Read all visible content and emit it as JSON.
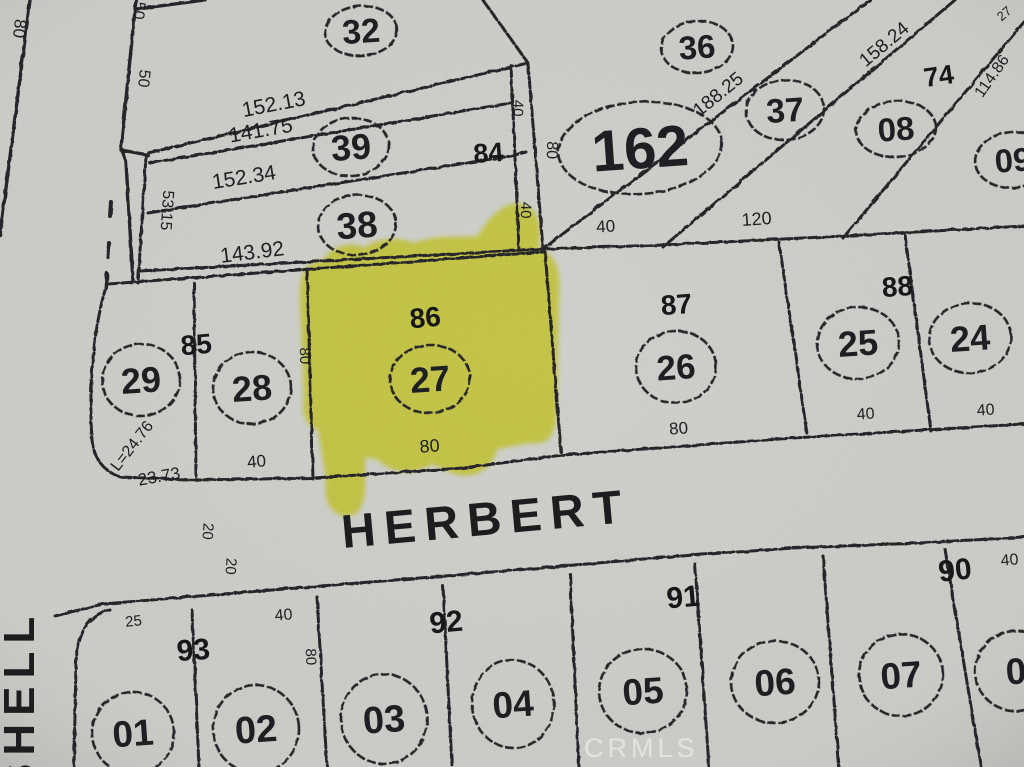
{
  "map": {
    "title": "plat-map-scan",
    "watermark": "CRMLS",
    "highlight_color": "#f0ee3c",
    "paper_color": "#d7d9d4",
    "ink_color": "#26272a",
    "street_labels": [
      {
        "text": "HERBERT",
        "x": 343,
        "y": 548,
        "s": 47,
        "r": -5.2,
        "ls": 9,
        "cls": "street",
        "name": "street-label-herbert"
      },
      {
        "text": "SHELL",
        "x": 34,
        "y": 793,
        "s": 44,
        "r": -90,
        "ls": 8,
        "cls": "street",
        "name": "street-label-shell"
      }
    ],
    "watermark_label": {
      "text": "CRMLS",
      "x": 584,
      "y": 757,
      "s": 27,
      "r": 0,
      "ls": 4,
      "cls": "watermark",
      "name": "watermark"
    },
    "lot_circles": [
      {
        "label": "32",
        "cx": 361,
        "cy": 31,
        "rx": 36,
        "ry": 25,
        "fs": 34
      },
      {
        "label": "39",
        "cx": 351,
        "cy": 147,
        "rx": 38,
        "ry": 29,
        "fs": 36
      },
      {
        "label": "38",
        "cx": 357,
        "cy": 225,
        "rx": 39,
        "ry": 30,
        "fs": 37
      },
      {
        "label": "36",
        "cx": 697,
        "cy": 47,
        "rx": 36,
        "ry": 26,
        "fs": 33
      },
      {
        "label": "37",
        "cx": 785,
        "cy": 110,
        "rx": 39,
        "ry": 30,
        "fs": 34
      },
      {
        "label": "08",
        "cx": 896,
        "cy": 129,
        "rx": 40,
        "ry": 28,
        "fs": 33
      },
      {
        "label": "09",
        "cx": 1013,
        "cy": 160,
        "rx": 38,
        "ry": 28,
        "fs": 33
      },
      {
        "label": "162",
        "cx": 640,
        "cy": 148,
        "rx": 82,
        "ry": 46,
        "fs": 58
      },
      {
        "label": "29",
        "cx": 141,
        "cy": 380,
        "rx": 39,
        "ry": 36,
        "fs": 36
      },
      {
        "label": "28",
        "cx": 252,
        "cy": 388,
        "rx": 39,
        "ry": 36,
        "fs": 36
      },
      {
        "label": "27",
        "cx": 430,
        "cy": 379,
        "rx": 40,
        "ry": 34,
        "fs": 36
      },
      {
        "label": "26",
        "cx": 676,
        "cy": 367,
        "rx": 40,
        "ry": 36,
        "fs": 35
      },
      {
        "label": "25",
        "cx": 858,
        "cy": 343,
        "rx": 41,
        "ry": 36,
        "fs": 36
      },
      {
        "label": "24",
        "cx": 970,
        "cy": 338,
        "rx": 41,
        "ry": 35,
        "fs": 36
      },
      {
        "label": "01",
        "cx": 133,
        "cy": 733,
        "rx": 41,
        "ry": 41,
        "fs": 37
      },
      {
        "label": "02",
        "cx": 256,
        "cy": 729,
        "rx": 43,
        "ry": 44,
        "fs": 38
      },
      {
        "label": "03",
        "cx": 384,
        "cy": 719,
        "rx": 43,
        "ry": 45,
        "fs": 38
      },
      {
        "label": "04",
        "cx": 513,
        "cy": 704,
        "rx": 41,
        "ry": 44,
        "fs": 37
      },
      {
        "label": "05",
        "cx": 643,
        "cy": 691,
        "rx": 44,
        "ry": 42,
        "fs": 37
      },
      {
        "label": "06",
        "cx": 775,
        "cy": 682,
        "rx": 44,
        "ry": 41,
        "fs": 37
      },
      {
        "label": "07",
        "cx": 901,
        "cy": 675,
        "rx": 42,
        "ry": 41,
        "fs": 37
      },
      {
        "label": "0",
        "cx": 1016,
        "cy": 671,
        "rx": 41,
        "ry": 40,
        "fs": 37
      }
    ],
    "block_numbers": [
      {
        "text": "84",
        "x": 489,
        "y": 162,
        "s": 27,
        "r": -4
      },
      {
        "text": "74",
        "x": 940,
        "y": 85,
        "s": 27,
        "r": -8
      },
      {
        "text": "85",
        "x": 197,
        "y": 354,
        "s": 28,
        "r": -5
      },
      {
        "text": "86",
        "x": 426,
        "y": 327,
        "s": 28,
        "r": -5
      },
      {
        "text": "87",
        "x": 677,
        "y": 314,
        "s": 28,
        "r": -4
      },
      {
        "text": "88",
        "x": 898,
        "y": 296,
        "s": 28,
        "r": -4
      },
      {
        "text": "93",
        "x": 194,
        "y": 660,
        "s": 30,
        "r": -4
      },
      {
        "text": "92",
        "x": 447,
        "y": 632,
        "s": 30,
        "r": -5
      },
      {
        "text": "91",
        "x": 684,
        "y": 607,
        "s": 30,
        "r": -5
      },
      {
        "text": "90",
        "x": 956,
        "y": 580,
        "s": 30,
        "r": -6
      }
    ],
    "dimension_labels": [
      {
        "text": "80",
        "x": 14,
        "y": 28,
        "s": 17,
        "r": 96
      },
      {
        "text": "50",
        "x": 134,
        "y": 10,
        "s": 16,
        "r": 96
      },
      {
        "text": "50",
        "x": 139,
        "y": 78,
        "s": 16,
        "r": 96
      },
      {
        "text": "152.13",
        "x": 275,
        "y": 111,
        "s": 21,
        "r": -11
      },
      {
        "text": "141.75",
        "x": 262,
        "y": 137,
        "s": 21,
        "r": -10
      },
      {
        "text": "152.34",
        "x": 245,
        "y": 184,
        "s": 21,
        "r": -9
      },
      {
        "text": "53.15",
        "x": 162,
        "y": 210,
        "s": 16,
        "r": 94
      },
      {
        "text": "143.92",
        "x": 253,
        "y": 259,
        "s": 21,
        "r": -7
      },
      {
        "text": "40",
        "x": 513,
        "y": 108,
        "s": 15,
        "r": 92
      },
      {
        "text": "80",
        "x": 547,
        "y": 150,
        "s": 16,
        "r": 92
      },
      {
        "text": "40",
        "x": 521,
        "y": 210,
        "s": 15,
        "r": 92
      },
      {
        "text": "40",
        "x": 606,
        "y": 232,
        "s": 17,
        "r": -3
      },
      {
        "text": "120",
        "x": 757,
        "y": 225,
        "s": 18,
        "r": -4
      },
      {
        "text": "188.25",
        "x": 722,
        "y": 99,
        "s": 19,
        "r": -39
      },
      {
        "text": "158.24",
        "x": 888,
        "y": 49,
        "s": 19,
        "r": -40
      },
      {
        "text": "114.86",
        "x": 996,
        "y": 79,
        "s": 16,
        "r": -55
      },
      {
        "text": "27",
        "x": 1007,
        "y": 17,
        "s": 13,
        "r": -40
      },
      {
        "text": "80",
        "x": 300,
        "y": 356,
        "s": 15,
        "r": 88
      },
      {
        "text": "L=24.76",
        "x": 136,
        "y": 449,
        "s": 16,
        "r": -52
      },
      {
        "text": "23.73",
        "x": 160,
        "y": 482,
        "s": 17,
        "r": -10
      },
      {
        "text": "40",
        "x": 257,
        "y": 467,
        "s": 17,
        "r": -5
      },
      {
        "text": "80",
        "x": 430,
        "y": 452,
        "s": 18,
        "r": -4
      },
      {
        "text": "80",
        "x": 679,
        "y": 434,
        "s": 17,
        "r": -4
      },
      {
        "text": "40",
        "x": 866,
        "y": 419,
        "s": 16,
        "r": -4
      },
      {
        "text": "40",
        "x": 986,
        "y": 415,
        "s": 16,
        "r": -4
      },
      {
        "text": "20",
        "x": 203,
        "y": 531,
        "s": 15,
        "r": 94
      },
      {
        "text": "20",
        "x": 226,
        "y": 566,
        "s": 15,
        "r": 94
      },
      {
        "text": "25",
        "x": 134,
        "y": 626,
        "s": 15,
        "r": -6
      },
      {
        "text": "40",
        "x": 284,
        "y": 620,
        "s": 16,
        "r": -5
      },
      {
        "text": "80",
        "x": 306,
        "y": 657,
        "s": 15,
        "r": 88
      },
      {
        "text": "40",
        "x": 1010,
        "y": 565,
        "s": 16,
        "r": -5
      }
    ]
  }
}
